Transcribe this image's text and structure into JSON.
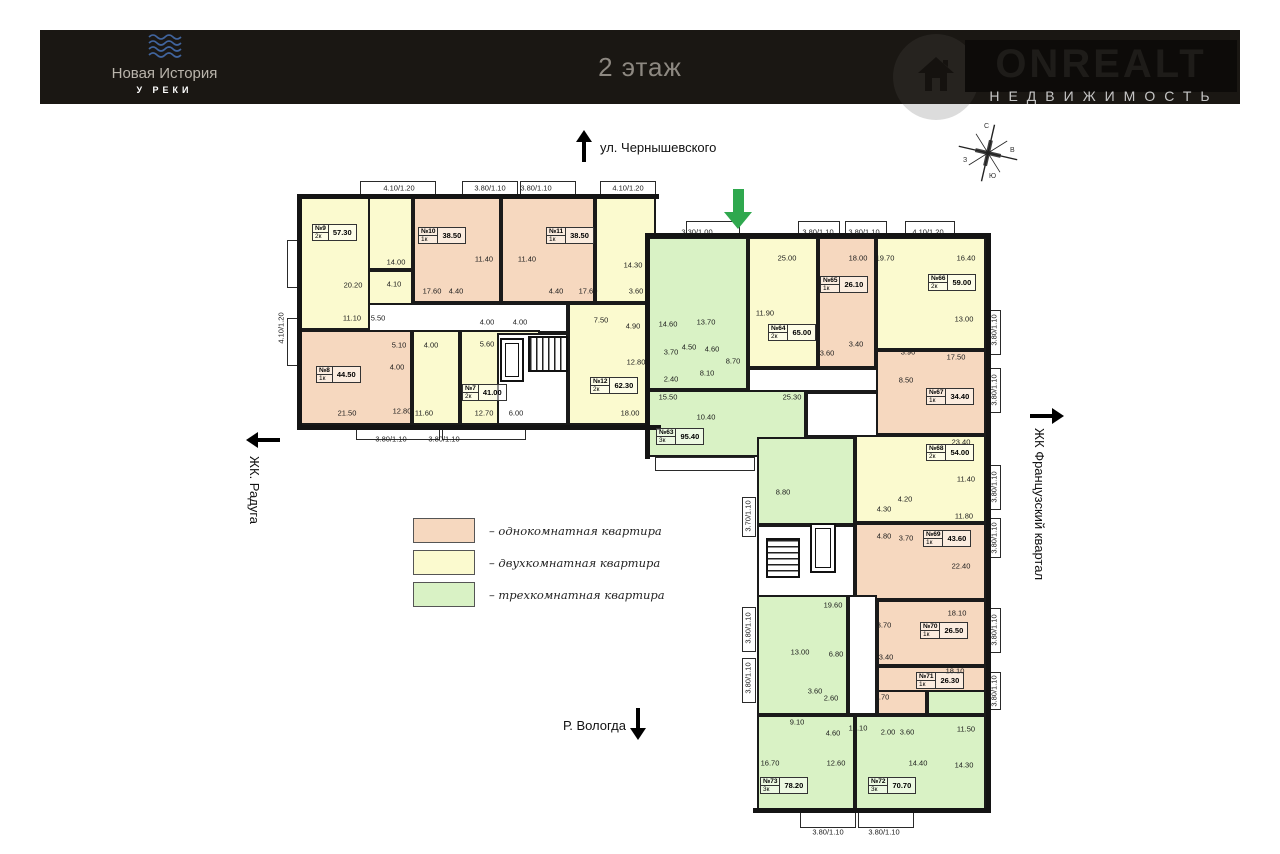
{
  "header": {
    "logo": {
      "title": "Новая История",
      "subtitle": "У РЕКИ"
    },
    "floor_title": "2 этаж",
    "brand": {
      "name": "ONREALT",
      "tagline": "НЕДВИЖИМОСТЬ"
    }
  },
  "directions": {
    "top": {
      "label": "ул. Чернышевского"
    },
    "left": {
      "label": "ЖК. Радуга"
    },
    "right": {
      "label": "ЖК Французский квартал"
    },
    "bottom": {
      "label": "Р. Вологда"
    }
  },
  "compass": {
    "n": "С",
    "e": "В",
    "s": "Ю",
    "w": "З"
  },
  "legend": {
    "items": [
      {
        "label": "– однокомнатная квартира",
        "color": "#f6d8bf"
      },
      {
        "label": "– двухкомнатная квартира",
        "color": "#fbfacf"
      },
      {
        "label": "– трехкомнатная квартира",
        "color": "#d9f2c5"
      }
    ]
  },
  "palette": {
    "1k": "#f6d8bf",
    "2k": "#fbfacf",
    "3k": "#d9f2c5",
    "cor": "#ffffff",
    "wall": "#141414",
    "entrance": "#2fa84e"
  },
  "plan": {
    "rooms": [
      {
        "x": 300,
        "y": 197,
        "w": 86,
        "h": 133,
        "t": "2k"
      },
      {
        "x": 368,
        "y": 197,
        "w": 45,
        "h": 73,
        "t": "2k"
      },
      {
        "x": 368,
        "y": 270,
        "w": 45,
        "h": 63,
        "t": "2k"
      },
      {
        "x": 413,
        "y": 197,
        "w": 88,
        "h": 106,
        "t": "1k"
      },
      {
        "x": 501,
        "y": 197,
        "w": 94,
        "h": 106,
        "t": "1k"
      },
      {
        "x": 595,
        "y": 197,
        "w": 61,
        "h": 106,
        "t": "2k"
      },
      {
        "x": 368,
        "y": 303,
        "w": 200,
        "h": 30,
        "t": "cor"
      },
      {
        "x": 300,
        "y": 330,
        "w": 112,
        "h": 95,
        "t": "1k"
      },
      {
        "x": 412,
        "y": 330,
        "w": 48,
        "h": 95,
        "t": "2k"
      },
      {
        "x": 460,
        "y": 330,
        "w": 80,
        "h": 95,
        "t": "2k"
      },
      {
        "x": 497,
        "y": 333,
        "w": 71,
        "h": 92,
        "t": "cor"
      },
      {
        "x": 568,
        "y": 303,
        "w": 88,
        "h": 122,
        "t": "2k"
      },
      {
        "x": 648,
        "y": 237,
        "w": 100,
        "h": 153,
        "t": "3k"
      },
      {
        "x": 648,
        "y": 390,
        "w": 158,
        "h": 67,
        "t": "3k"
      },
      {
        "x": 748,
        "y": 237,
        "w": 70,
        "h": 131,
        "t": "2k"
      },
      {
        "x": 748,
        "y": 368,
        "w": 130,
        "h": 24,
        "t": "cor"
      },
      {
        "x": 806,
        "y": 392,
        "w": 72,
        "h": 45,
        "t": "cor"
      },
      {
        "x": 818,
        "y": 237,
        "w": 58,
        "h": 131,
        "t": "1k"
      },
      {
        "x": 876,
        "y": 237,
        "w": 110,
        "h": 113,
        "t": "2k"
      },
      {
        "x": 876,
        "y": 350,
        "w": 110,
        "h": 85,
        "t": "1k"
      },
      {
        "x": 757,
        "y": 437,
        "w": 98,
        "h": 88,
        "t": "3k"
      },
      {
        "x": 855,
        "y": 435,
        "w": 131,
        "h": 88,
        "t": "2k"
      },
      {
        "x": 757,
        "y": 525,
        "w": 98,
        "h": 72,
        "t": "cor"
      },
      {
        "x": 855,
        "y": 523,
        "w": 131,
        "h": 77,
        "t": "1k"
      },
      {
        "x": 877,
        "y": 600,
        "w": 109,
        "h": 66,
        "t": "1k"
      },
      {
        "x": 877,
        "y": 666,
        "w": 109,
        "h": 44,
        "t": "1k"
      },
      {
        "x": 757,
        "y": 595,
        "w": 91,
        "h": 120,
        "t": "3k"
      },
      {
        "x": 848,
        "y": 595,
        "w": 29,
        "h": 120,
        "t": "cor"
      },
      {
        "x": 877,
        "y": 690,
        "w": 50,
        "h": 25,
        "t": "1k"
      },
      {
        "x": 927,
        "y": 690,
        "w": 59,
        "h": 25,
        "t": "3k"
      },
      {
        "x": 757,
        "y": 715,
        "w": 98,
        "h": 97,
        "t": "3k"
      },
      {
        "x": 855,
        "y": 715,
        "w": 131,
        "h": 97,
        "t": "3k"
      }
    ],
    "walls": [
      {
        "x": 297,
        "y": 194,
        "w": 362,
        "h": 5
      },
      {
        "x": 297,
        "y": 194,
        "w": 5,
        "h": 236
      },
      {
        "x": 297,
        "y": 425,
        "w": 364,
        "h": 5
      },
      {
        "x": 645,
        "y": 233,
        "w": 346,
        "h": 5
      },
      {
        "x": 986,
        "y": 233,
        "w": 5,
        "h": 445
      },
      {
        "x": 645,
        "y": 233,
        "w": 5,
        "h": 226
      },
      {
        "x": 753,
        "y": 808,
        "w": 238,
        "h": 5
      },
      {
        "x": 986,
        "y": 678,
        "w": 5,
        "h": 134
      }
    ],
    "balconies": [
      {
        "x": 360,
        "y": 181,
        "w": 76,
        "h": 16
      },
      {
        "x": 462,
        "y": 181,
        "w": 56,
        "h": 16
      },
      {
        "x": 520,
        "y": 181,
        "w": 56,
        "h": 16
      },
      {
        "x": 600,
        "y": 181,
        "w": 56,
        "h": 16
      },
      {
        "x": 356,
        "y": 425,
        "w": 84,
        "h": 15
      },
      {
        "x": 442,
        "y": 425,
        "w": 84,
        "h": 15
      },
      {
        "x": 287,
        "y": 240,
        "w": 13,
        "h": 48
      },
      {
        "x": 287,
        "y": 318,
        "w": 13,
        "h": 48
      },
      {
        "x": 686,
        "y": 221,
        "w": 54,
        "h": 16
      },
      {
        "x": 798,
        "y": 221,
        "w": 42,
        "h": 16
      },
      {
        "x": 845,
        "y": 221,
        "w": 42,
        "h": 16
      },
      {
        "x": 905,
        "y": 221,
        "w": 50,
        "h": 16
      },
      {
        "x": 655,
        "y": 457,
        "w": 100,
        "h": 14
      },
      {
        "x": 986,
        "y": 310,
        "w": 15,
        "h": 45
      },
      {
        "x": 986,
        "y": 368,
        "w": 15,
        "h": 45
      },
      {
        "x": 986,
        "y": 465,
        "w": 15,
        "h": 45
      },
      {
        "x": 986,
        "y": 518,
        "w": 15,
        "h": 40
      },
      {
        "x": 986,
        "y": 608,
        "w": 15,
        "h": 45
      },
      {
        "x": 986,
        "y": 672,
        "w": 15,
        "h": 38
      },
      {
        "x": 742,
        "y": 497,
        "w": 14,
        "h": 40
      },
      {
        "x": 742,
        "y": 607,
        "w": 14,
        "h": 45
      },
      {
        "x": 742,
        "y": 658,
        "w": 14,
        "h": 45
      },
      {
        "x": 800,
        "y": 812,
        "w": 56,
        "h": 16
      },
      {
        "x": 858,
        "y": 812,
        "w": 56,
        "h": 16
      }
    ],
    "stairs": [
      {
        "x": 528,
        "y": 336,
        "w": 40,
        "h": 36,
        "d": "h"
      },
      {
        "x": 766,
        "y": 538,
        "w": 34,
        "h": 40,
        "d": "v"
      }
    ],
    "elevators": [
      {
        "x": 500,
        "y": 338,
        "w": 24,
        "h": 44
      },
      {
        "x": 810,
        "y": 523,
        "w": 26,
        "h": 50
      }
    ],
    "apartments": [
      {
        "num": "№9",
        "type": "2к",
        "area": "57.30",
        "x": 312,
        "y": 224
      },
      {
        "num": "№10",
        "type": "1к",
        "area": "38.50",
        "x": 418,
        "y": 227
      },
      {
        "num": "№11",
        "type": "1к",
        "area": "38.50",
        "x": 546,
        "y": 227
      },
      {
        "num": "№8",
        "type": "1к",
        "area": "44.50",
        "x": 316,
        "y": 366
      },
      {
        "num": "№7",
        "type": "2к",
        "area": "41.00",
        "x": 462,
        "y": 384
      },
      {
        "num": "№12",
        "type": "2к",
        "area": "62.30",
        "x": 590,
        "y": 377
      },
      {
        "num": "№63",
        "type": "3к",
        "area": "95.40",
        "x": 656,
        "y": 428
      },
      {
        "num": "№64",
        "type": "2к",
        "area": "65.00",
        "x": 768,
        "y": 324
      },
      {
        "num": "№65",
        "type": "1к",
        "area": "26.10",
        "x": 820,
        "y": 276
      },
      {
        "num": "№66",
        "type": "2к",
        "area": "59.00",
        "x": 928,
        "y": 274
      },
      {
        "num": "№67",
        "type": "1к",
        "area": "34.40",
        "x": 926,
        "y": 388
      },
      {
        "num": "№68",
        "type": "2к",
        "area": "54.00",
        "x": 926,
        "y": 444
      },
      {
        "num": "№69",
        "type": "1к",
        "area": "43.60",
        "x": 923,
        "y": 530
      },
      {
        "num": "№70",
        "type": "1к",
        "area": "26.50",
        "x": 920,
        "y": 622
      },
      {
        "num": "№71",
        "type": "1к",
        "area": "26.30",
        "x": 916,
        "y": 672
      },
      {
        "num": "№72",
        "type": "3к",
        "area": "70.70",
        "x": 868,
        "y": 777
      },
      {
        "num": "№73",
        "type": "3к",
        "area": "78.20",
        "x": 760,
        "y": 777
      }
    ],
    "dims": [
      {
        "t": "4.10/1.20",
        "x": 399,
        "y": 188
      },
      {
        "t": "3.80/1.10",
        "x": 490,
        "y": 188
      },
      {
        "t": "3.80/1.10",
        "x": 536,
        "y": 188
      },
      {
        "t": "4.10/1.20",
        "x": 628,
        "y": 188
      },
      {
        "t": "4.10/1.20",
        "x": 281,
        "y": 328,
        "r": 1
      },
      {
        "t": "20.20",
        "x": 353,
        "y": 285
      },
      {
        "t": "14.00",
        "x": 396,
        "y": 262
      },
      {
        "t": "4.10",
        "x": 394,
        "y": 284
      },
      {
        "t": "11.40",
        "x": 484,
        "y": 259
      },
      {
        "t": "11.40",
        "x": 527,
        "y": 259
      },
      {
        "t": "17.60",
        "x": 432,
        "y": 291
      },
      {
        "t": "4.40",
        "x": 456,
        "y": 291
      },
      {
        "t": "4.00",
        "x": 487,
        "y": 322
      },
      {
        "t": "4.00",
        "x": 520,
        "y": 322
      },
      {
        "t": "4.40",
        "x": 556,
        "y": 291
      },
      {
        "t": "17.60",
        "x": 588,
        "y": 291
      },
      {
        "t": "11.10",
        "x": 352,
        "y": 318
      },
      {
        "t": "5.50",
        "x": 378,
        "y": 318
      },
      {
        "t": "14.30",
        "x": 633,
        "y": 265
      },
      {
        "t": "3.60",
        "x": 636,
        "y": 291
      },
      {
        "t": "5.10",
        "x": 399,
        "y": 345
      },
      {
        "t": "4.00",
        "x": 431,
        "y": 345
      },
      {
        "t": "4.00",
        "x": 397,
        "y": 367
      },
      {
        "t": "5.60",
        "x": 487,
        "y": 344
      },
      {
        "t": "21.50",
        "x": 347,
        "y": 413
      },
      {
        "t": "12.80",
        "x": 402,
        "y": 411
      },
      {
        "t": "11.60",
        "x": 424,
        "y": 413
      },
      {
        "t": "12.70",
        "x": 484,
        "y": 413
      },
      {
        "t": "6.00",
        "x": 516,
        "y": 413
      },
      {
        "t": "7.50",
        "x": 601,
        "y": 320
      },
      {
        "t": "4.90",
        "x": 633,
        "y": 326
      },
      {
        "t": "12.80",
        "x": 636,
        "y": 362
      },
      {
        "t": "18.00",
        "x": 630,
        "y": 413
      },
      {
        "t": "3.80/1.10",
        "x": 391,
        "y": 439
      },
      {
        "t": "3.80/1.10",
        "x": 444,
        "y": 439
      },
      {
        "t": "3.30/1.00",
        "x": 697,
        "y": 232
      },
      {
        "t": "3.80/1.10",
        "x": 818,
        "y": 232
      },
      {
        "t": "3.80/1.10",
        "x": 864,
        "y": 232
      },
      {
        "t": "4.10/1.20",
        "x": 928,
        "y": 232
      },
      {
        "t": "25.00",
        "x": 787,
        "y": 258
      },
      {
        "t": "18.00",
        "x": 858,
        "y": 258
      },
      {
        "t": "19.70",
        "x": 885,
        "y": 258
      },
      {
        "t": "16.40",
        "x": 966,
        "y": 258
      },
      {
        "t": "14.60",
        "x": 668,
        "y": 324
      },
      {
        "t": "13.70",
        "x": 706,
        "y": 322
      },
      {
        "t": "11.90",
        "x": 765,
        "y": 313
      },
      {
        "t": "3.70",
        "x": 671,
        "y": 352
      },
      {
        "t": "4.50",
        "x": 689,
        "y": 347
      },
      {
        "t": "4.60",
        "x": 712,
        "y": 349
      },
      {
        "t": "8.70",
        "x": 733,
        "y": 361
      },
      {
        "t": "3.40",
        "x": 856,
        "y": 344
      },
      {
        "t": "3.60",
        "x": 827,
        "y": 353
      },
      {
        "t": "3.90",
        "x": 908,
        "y": 352
      },
      {
        "t": "13.00",
        "x": 964,
        "y": 319
      },
      {
        "t": "2.40",
        "x": 671,
        "y": 379
      },
      {
        "t": "8.10",
        "x": 707,
        "y": 373
      },
      {
        "t": "15.50",
        "x": 668,
        "y": 397
      },
      {
        "t": "10.40",
        "x": 706,
        "y": 417
      },
      {
        "t": "25.30",
        "x": 792,
        "y": 397
      },
      {
        "t": "17.50",
        "x": 956,
        "y": 357
      },
      {
        "t": "8.50",
        "x": 906,
        "y": 380
      },
      {
        "t": "23.40",
        "x": 961,
        "y": 442
      },
      {
        "t": "11.40",
        "x": 966,
        "y": 479
      },
      {
        "t": "4.20",
        "x": 905,
        "y": 499
      },
      {
        "t": "4.30",
        "x": 884,
        "y": 509
      },
      {
        "t": "8.80",
        "x": 783,
        "y": 492
      },
      {
        "t": "11.80",
        "x": 964,
        "y": 516
      },
      {
        "t": "4.80",
        "x": 884,
        "y": 536
      },
      {
        "t": "3.70",
        "x": 906,
        "y": 538
      },
      {
        "t": "22.40",
        "x": 961,
        "y": 566
      },
      {
        "t": "19.60",
        "x": 833,
        "y": 605
      },
      {
        "t": "13.00",
        "x": 800,
        "y": 652
      },
      {
        "t": "6.80",
        "x": 836,
        "y": 654
      },
      {
        "t": "3.60",
        "x": 815,
        "y": 691
      },
      {
        "t": "2.60",
        "x": 831,
        "y": 698
      },
      {
        "t": "18.10",
        "x": 957,
        "y": 613
      },
      {
        "t": "3.70",
        "x": 884,
        "y": 625
      },
      {
        "t": "3.40",
        "x": 886,
        "y": 657
      },
      {
        "t": "18.10",
        "x": 955,
        "y": 671
      },
      {
        "t": "3.70",
        "x": 882,
        "y": 697
      },
      {
        "t": "10.10",
        "x": 858,
        "y": 728
      },
      {
        "t": "2.00",
        "x": 888,
        "y": 732
      },
      {
        "t": "3.60",
        "x": 907,
        "y": 732
      },
      {
        "t": "11.50",
        "x": 966,
        "y": 729
      },
      {
        "t": "9.10",
        "x": 797,
        "y": 722
      },
      {
        "t": "4.60",
        "x": 833,
        "y": 733
      },
      {
        "t": "16.70",
        "x": 770,
        "y": 763
      },
      {
        "t": "12.60",
        "x": 836,
        "y": 763
      },
      {
        "t": "14.40",
        "x": 918,
        "y": 763
      },
      {
        "t": "14.30",
        "x": 964,
        "y": 765
      },
      {
        "t": "3.80/1.10",
        "x": 828,
        "y": 832
      },
      {
        "t": "3.80/1.10",
        "x": 884,
        "y": 832
      },
      {
        "t": "3.80/1.10",
        "x": 994,
        "y": 330,
        "r": 1
      },
      {
        "t": "3.80/1.10",
        "x": 994,
        "y": 390,
        "r": 1
      },
      {
        "t": "3.80/1.10",
        "x": 994,
        "y": 487,
        "r": 1
      },
      {
        "t": "3.80/1.10",
        "x": 994,
        "y": 538,
        "r": 1
      },
      {
        "t": "3.80/1.10",
        "x": 994,
        "y": 630,
        "r": 1
      },
      {
        "t": "3.80/1.10",
        "x": 994,
        "y": 691,
        "r": 1
      },
      {
        "t": "3.70/1.10",
        "x": 748,
        "y": 516,
        "r": 1
      },
      {
        "t": "3.80/1.10",
        "x": 748,
        "y": 628,
        "r": 1
      },
      {
        "t": "3.80/1.10",
        "x": 748,
        "y": 678,
        "r": 1
      }
    ],
    "entrance_arrow": {
      "x": 724,
      "y": 189
    }
  }
}
